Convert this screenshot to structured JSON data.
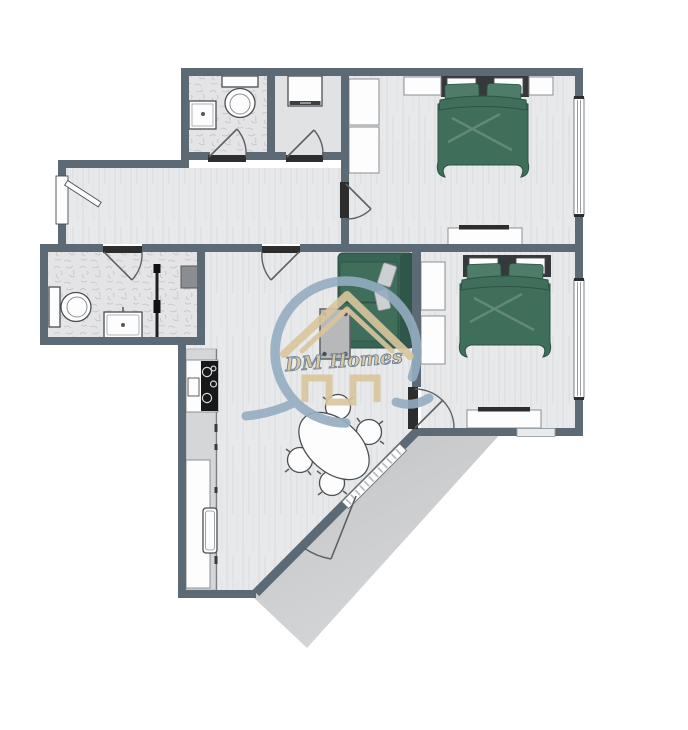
{
  "meta": {
    "title": "Two-bedroom apartment floor plan with deck"
  },
  "logo": {
    "text": "DM Homes",
    "mark": "house-roof-and-swoosh"
  },
  "colors": {
    "wall": "#5b6a74",
    "floorBase": "#e8e9eb",
    "floorStreak": "#dfe1e4",
    "bathBase": "#e4e4e6",
    "bathFleck": "#c7c8cb",
    "laundryFloor": "#e1e2e4",
    "green": "#3f6e5b",
    "greenDark": "#2d5345",
    "pillowGreen": "#4d7d68",
    "sofa": "#386456",
    "deckA": "#c3c4c6",
    "deckB": "#d8d9da",
    "counter": "#d4d6d8",
    "fixtWhite": "#fdfdfd",
    "outline": "#4a4f53",
    "doorbar": "#2d2d2d",
    "arcline": "#5c6165",
    "logoBlue": "#94adc1",
    "logoTan": "#d9c69c",
    "grayBox": "#8a8e92"
  },
  "rooms": [
    {
      "id": "bathroom-top",
      "features": [
        "toilet",
        "vanity-sink",
        "swing-door"
      ]
    },
    {
      "id": "laundry-closet",
      "features": [
        "washer",
        "swing-door"
      ]
    },
    {
      "id": "bedroom-1",
      "features": [
        "double-bed-green",
        "closet-shelves",
        "nightstands",
        "dresser-tv",
        "window-right",
        "swing-door"
      ]
    },
    {
      "id": "hallway",
      "features": [
        "entry-door-left"
      ]
    },
    {
      "id": "bathroom-bottom",
      "features": [
        "toilet",
        "vanity-sink",
        "sliding-door-track",
        "utility-box",
        "swing-door"
      ]
    },
    {
      "id": "living-dining",
      "features": [
        "sofa-green",
        "coffee-table",
        "dining-table-oval",
        "four-chairs",
        "patio-door",
        "diagonal-window"
      ]
    },
    {
      "id": "kitchen",
      "features": [
        "stove-4-burners",
        "counter",
        "sink",
        "cabinets"
      ]
    },
    {
      "id": "bedroom-2",
      "features": [
        "double-bed-green",
        "closet-shelves",
        "dresser-tv",
        "window-right",
        "window-bottom",
        "swing-door"
      ]
    },
    {
      "id": "deck",
      "features": [
        "angled-patio"
      ]
    }
  ]
}
